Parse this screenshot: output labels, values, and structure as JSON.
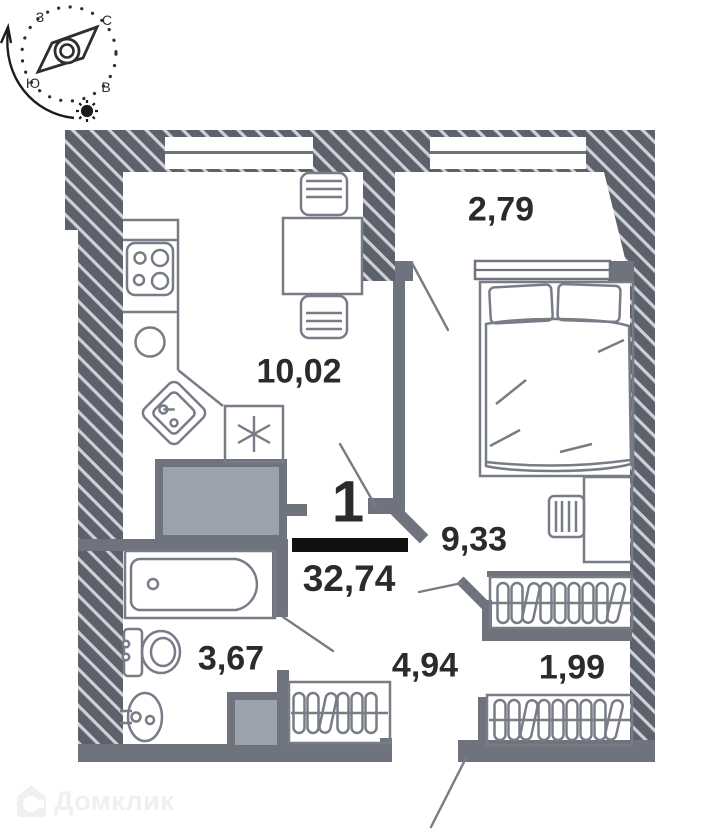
{
  "compass": {
    "north": "С",
    "south": "Ю",
    "west": "З",
    "east": "В"
  },
  "apartment": {
    "number": "1",
    "total_area": "32,74"
  },
  "rooms": {
    "balcony": {
      "area": "2,79"
    },
    "kitchen_living": {
      "area": "10,02"
    },
    "bedroom": {
      "area": "9,33"
    },
    "bathroom": {
      "area": "3,67"
    },
    "hallway": {
      "area": "4,94"
    },
    "wardrobe": {
      "area": "1,99"
    }
  },
  "watermark": {
    "brand": "Домклик"
  },
  "colors": {
    "wall_fill": "#5c616c",
    "wall_hatch_line": "#ced1d6",
    "partition_gray": "#6f737d",
    "furniture_stroke": "#787c86",
    "shaft_fill": "#9ca2ac",
    "label_ink": "#2b2b2b",
    "fraction_bar": "#111111",
    "watermark_gray": "#eef0f1"
  }
}
